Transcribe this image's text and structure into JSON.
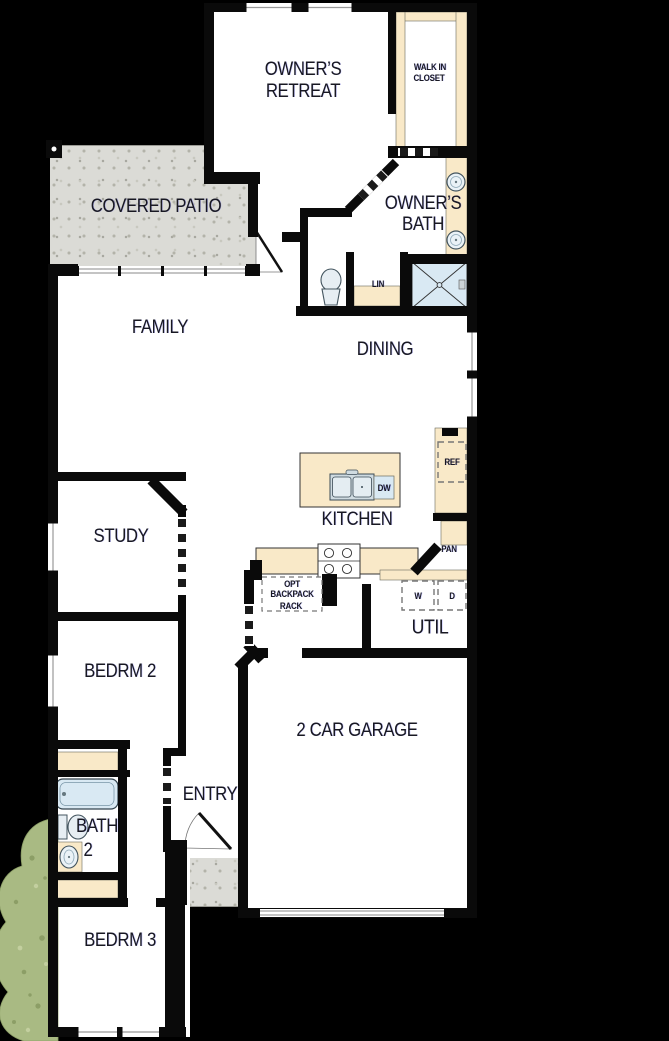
{
  "colors": {
    "background": "#000000",
    "floor": "#ffffff",
    "wall": "#0a0a0a",
    "counter_beige": "#f9e9c8",
    "fixture_blue": "#d9e9f3",
    "patio_gray": "#dbdbd6",
    "bush_green": "#a9ba83",
    "label_text": "#181822"
  },
  "rooms": {
    "owners_retreat": {
      "line1": "OWNER’S",
      "line2": "RETREAT"
    },
    "walk_in_closet": {
      "line1": "WALK IN",
      "line2": "CLOSET"
    },
    "covered_patio": {
      "label": "COVERED PATIO"
    },
    "owners_bath": {
      "line1": "OWNER’S",
      "line2": "BATH"
    },
    "family": {
      "label": "FAMILY"
    },
    "dining": {
      "label": "DINING"
    },
    "kitchen": {
      "label": "KITCHEN"
    },
    "study": {
      "label": "STUDY"
    },
    "util": {
      "label": "UTIL"
    },
    "bedroom2": {
      "label": "BEDRM 2"
    },
    "garage": {
      "label": "2 CAR GARAGE"
    },
    "entry": {
      "label": "ENTRY"
    },
    "bath2": {
      "line1": "BATH",
      "line2": "2"
    },
    "bedroom3": {
      "label": "BEDRM 3"
    }
  },
  "fixtures": {
    "linen": "LIN",
    "dishwasher": "DW",
    "refrigerator": "REF",
    "pantry": "PAN",
    "washer": "W",
    "dryer": "D",
    "backpack_rack": {
      "line1": "OPT",
      "line2": "BACKPACK",
      "line3": "RACK"
    }
  }
}
